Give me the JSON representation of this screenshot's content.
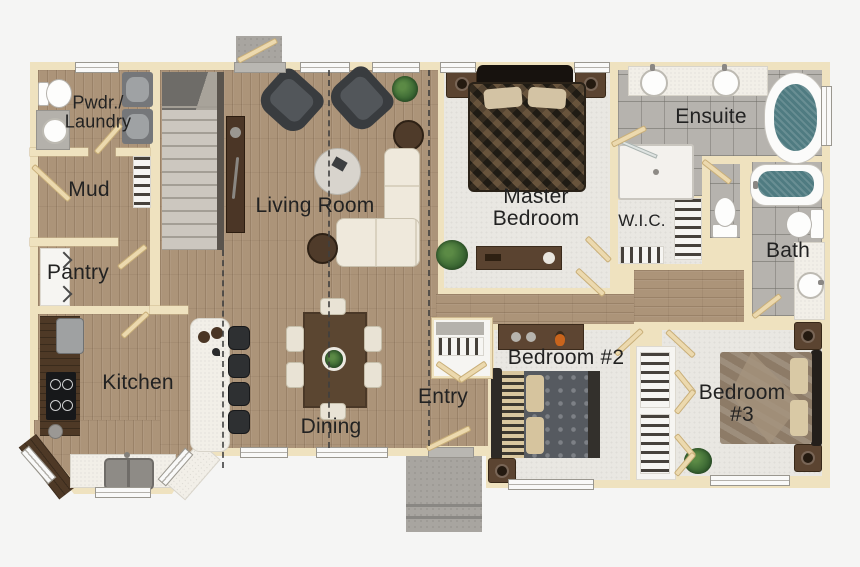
{
  "labels": {
    "pwdr_laundry": {
      "line1": "Pwdr./",
      "line2": "Laundry"
    },
    "mud": "Mud",
    "pantry": "Pantry",
    "kitchen": "Kitchen",
    "living": "Living Room",
    "dining": "Dining",
    "entry": "Entry",
    "master": {
      "line1": "Master",
      "line2": "Bedroom"
    },
    "wic": "W.I.C.",
    "ensuite": "Ensuite",
    "bath": "Bath",
    "bedroom2": "Bedroom #2",
    "bedroom3": {
      "line1": "Bedroom",
      "line2": "#3"
    }
  },
  "colors": {
    "bg": "#f5f5f4",
    "wall": "#efe2bf",
    "wall_edge": "#cdb88e",
    "wood": "#ac9479",
    "carpet": "#e9e7e2",
    "tile": "#b6b3ae",
    "water": "#4f7b81",
    "counter": "#f2efe8",
    "counter_dark": "#4e3926",
    "porch": "#a8a5a0",
    "stairs": "#ccc7bf",
    "text": "#222222",
    "furn_dark": "#393c3f",
    "furn_wood": "#5b4431",
    "sofa": "#efe9dc",
    "door": "#ecd9ae"
  }
}
